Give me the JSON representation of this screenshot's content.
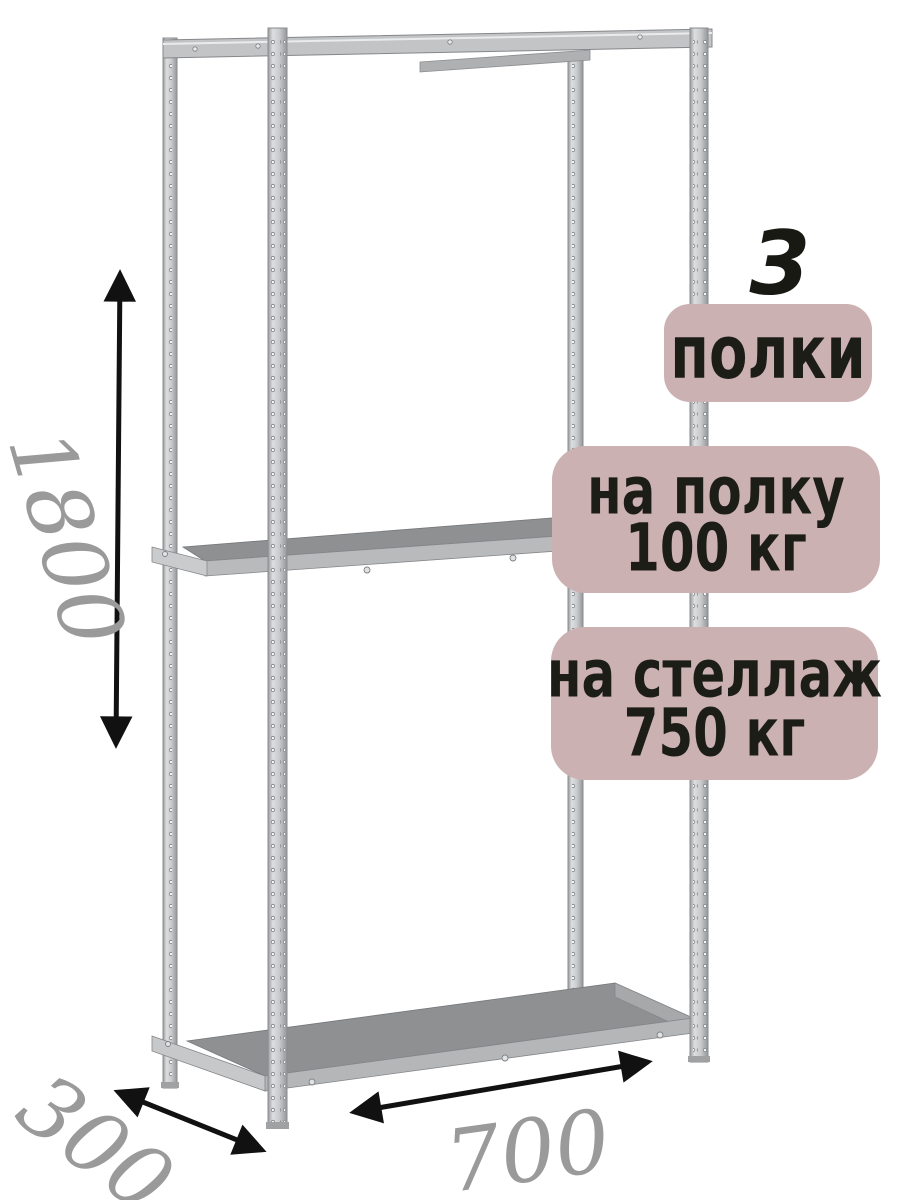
{
  "product_view": {
    "description": "metal shelving rack 3D render with annotations",
    "shelf_count_number": "3",
    "badges": {
      "shelves": {
        "label": "полки"
      },
      "per_shelf": {
        "line1": "на полку",
        "line2": "100 кг"
      },
      "per_rack": {
        "line1": "на стеллаж",
        "line2": "750 кг"
      }
    },
    "dimensions": {
      "height_mm": "1800",
      "depth_mm": "300",
      "width_mm": "700"
    },
    "colors": {
      "badge_bg": "#ccb1b3",
      "badge_text": "#1d1d18",
      "dimension_text": "#9a9a9a",
      "arrow": "#111111",
      "metal_light": "#dcdee0",
      "metal_mid": "#c2c4c6",
      "metal_edge": "#8a8c8e",
      "shelf_top": "#8e9092",
      "background": "#ffffff"
    }
  }
}
